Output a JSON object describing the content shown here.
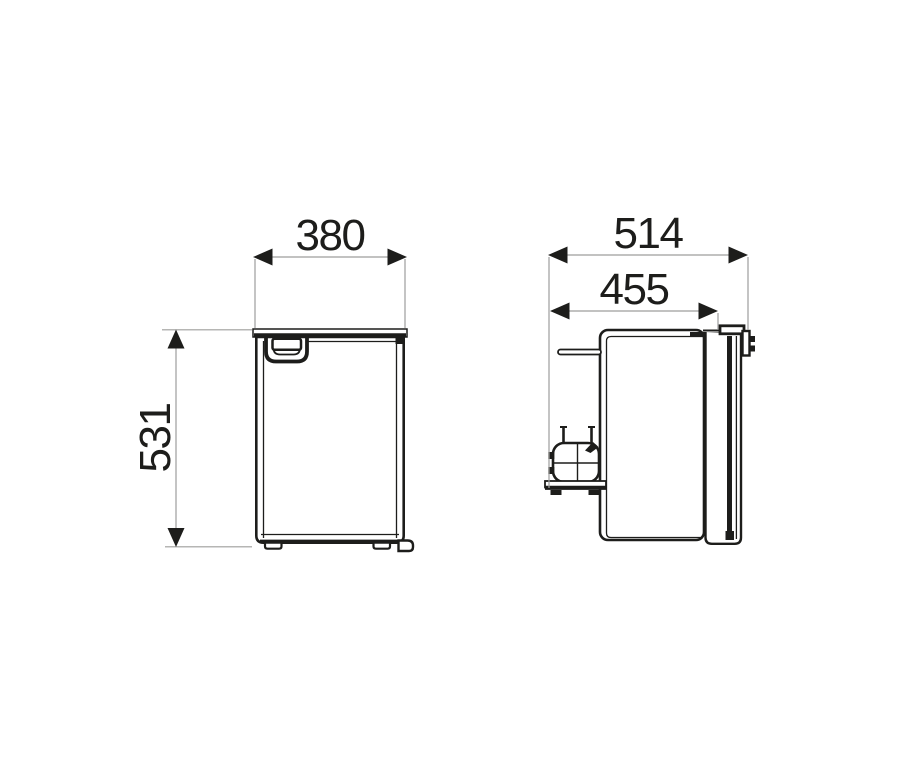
{
  "drawing": {
    "views": {
      "front": {
        "width_label": "380",
        "height_label": "531"
      },
      "side": {
        "total_depth_label": "514",
        "body_depth_label": "455"
      }
    },
    "colors": {
      "background": "#ffffff",
      "outline": "#1d1d1b",
      "dimension_line": "#9d9d9c",
      "arrowhead": "#1d1d1b"
    }
  }
}
